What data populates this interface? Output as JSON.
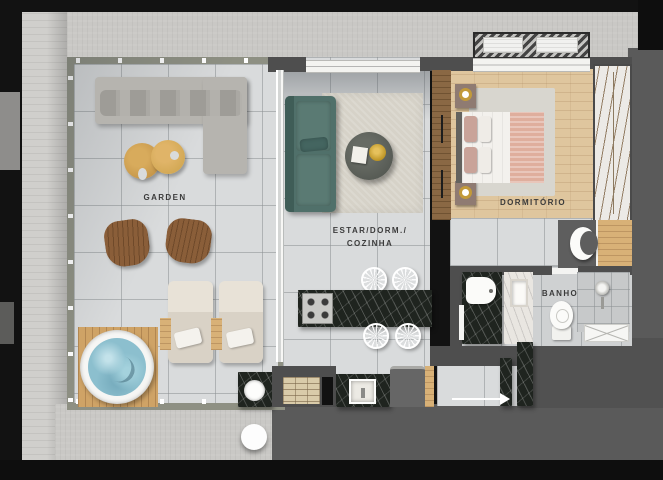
{
  "labels": {
    "garden": "GARDEN",
    "living_line1": "ESTAR/DORM./",
    "living_line2": "COZINHA",
    "bedroom": "DORMITÓRIO",
    "bathroom": "BANHO"
  },
  "palette": {
    "floor_tile": "#d9dbdc",
    "wood_floor": "#dfc69e",
    "wall_dark": "#4e4e4e",
    "concrete": "#c9c8c5",
    "sofa_teal": "#50706a",
    "marble_dark": "#1f241f",
    "hot_tub_water": "#8cbfce",
    "deck_wood": "#cfa366",
    "accent_gold": "#b9901f",
    "blanket_pink": "#dfae9d",
    "label_text": "#3b3b3b"
  }
}
